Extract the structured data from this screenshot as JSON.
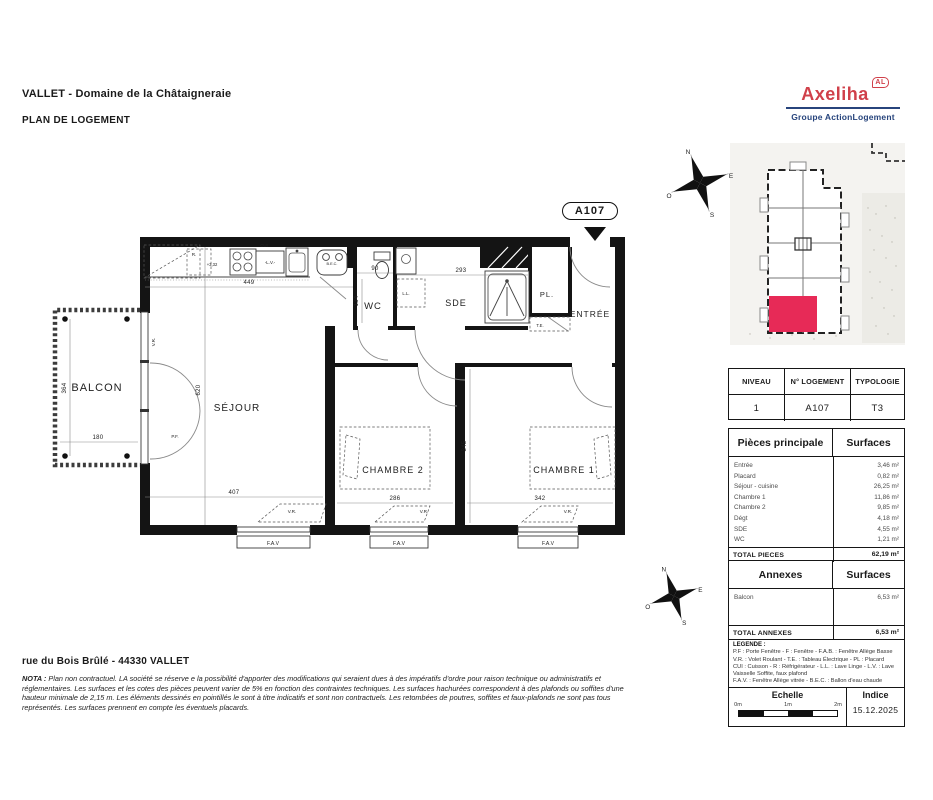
{
  "header": {
    "project_title": "VALLET - Domaine de la Châtaigneraie",
    "doc_type": "PLAN DE LOGEMENT",
    "logo": {
      "brand": "Axeliha",
      "badge": "AL",
      "subtitle": "Groupe ActionLogement",
      "brand_color": "#d0404a",
      "subtitle_color": "#27447c"
    }
  },
  "unit_tag": "A107",
  "site_plan": {
    "compass": {
      "n": "N",
      "e": "E",
      "s": "S",
      "o": "O"
    },
    "highlight_color": "#e72a57"
  },
  "plan": {
    "rooms": {
      "balcon": "BALCON",
      "sejour": "SÉJOUR",
      "wc": "WC",
      "sde": "SDE",
      "pl": "PL.",
      "entree": "ENTRÉE",
      "chambre2": "CHAMBRE 2",
      "chambre1": "CHAMBRE 1"
    },
    "dims": {
      "d449": "449",
      "d620": "620",
      "d407": "407",
      "d90": "90",
      "d293": "293",
      "d134": "134",
      "d286": "286",
      "d342": "342",
      "d345": "345",
      "d364": "364",
      "d180": "180"
    },
    "ann": {
      "r": "R.",
      "level": "+3,32",
      "cui": "CUI",
      "lv": "-L.V.-",
      "bec": "B.E.C.",
      "ll": "L.L.",
      "te": "T.E.",
      "vr": "V.R.",
      "pf": "P.F.",
      "fav": "F.A.V"
    }
  },
  "info_table": {
    "headers": [
      "NIVEAU",
      "N° LOGEMENT",
      "TYPOLOGIE"
    ],
    "values": [
      "1",
      "A107",
      "T3"
    ]
  },
  "surfaces_table": {
    "col1": "Pièces principale",
    "col2": "Surfaces",
    "rows": [
      [
        "Entrée",
        "3,46 m²"
      ],
      [
        "Placard",
        "0,82 m²"
      ],
      [
        "Séjour - cuisine",
        "26,25 m²"
      ],
      [
        "Chambre 1",
        "11,86 m²"
      ],
      [
        "Chambre 2",
        "9,85 m²"
      ],
      [
        "Dégt",
        "4,18 m²"
      ],
      [
        "SDE",
        "4,55 m²"
      ],
      [
        "WC",
        "1,21 m²"
      ]
    ],
    "total_label": "TOTAL PIECES",
    "total_value": "62,19 m²"
  },
  "annexes_table": {
    "col1": "Annexes",
    "col2": "Surfaces",
    "rows": [
      [
        "Balcon",
        "6,53 m²"
      ]
    ],
    "total_label": "TOTAL ANNEXES",
    "total_value": "6,53 m²"
  },
  "legend": {
    "title": "LEGENDE :",
    "lines": [
      "P.F : Porte Fenêtre  -  F : Fenêtre  -  F.A.B. : Fenêtre Allège Basse",
      "V.R. : Volet Roulant  -  T.E. : Tableau Électrique  -  PL : Placard",
      "CUI : Cuisson  -  R : Réfrigérateur  -  L.L. : Lave Linge  -  L.V. : Lave Vaisselle",
      "Soffite, faux plafond",
      "F.A.V. : Fenêtre Allège vitrée  -  B.E.C. : Ballon d'eau chaude"
    ]
  },
  "scale_box": {
    "title": "Echelle",
    "ticks": [
      "0m",
      "1m",
      "2m"
    ]
  },
  "indice_box": {
    "title": "Indice",
    "value": "15.12.2025"
  },
  "footer": {
    "address": "rue du Bois Brûlé - 44330 VALLET",
    "nota_label": "NOTA :",
    "nota_text": "Plan non contractuel. LA société se réserve e la possibilité d'apporter des modifications qui seraient dues à des impératifs d'ordre pour raison technique ou administratifs et réglementaires. Les surfaces et les cotes des pièces peuvent varier de 5% en fonction des contraintes techniques. Les surfaces hachurées correspondent à des plafonds ou soffites d'une hauteur minimale de 2,15 m. Les éléments dessinés en pointillés le sont à titre indicatifs et sont non contractuels. Les retombées de poutres, soffites et faux-plafonds ne sont pas tous représentés. Les surfaces prennent en compte les éventuels placards."
  }
}
